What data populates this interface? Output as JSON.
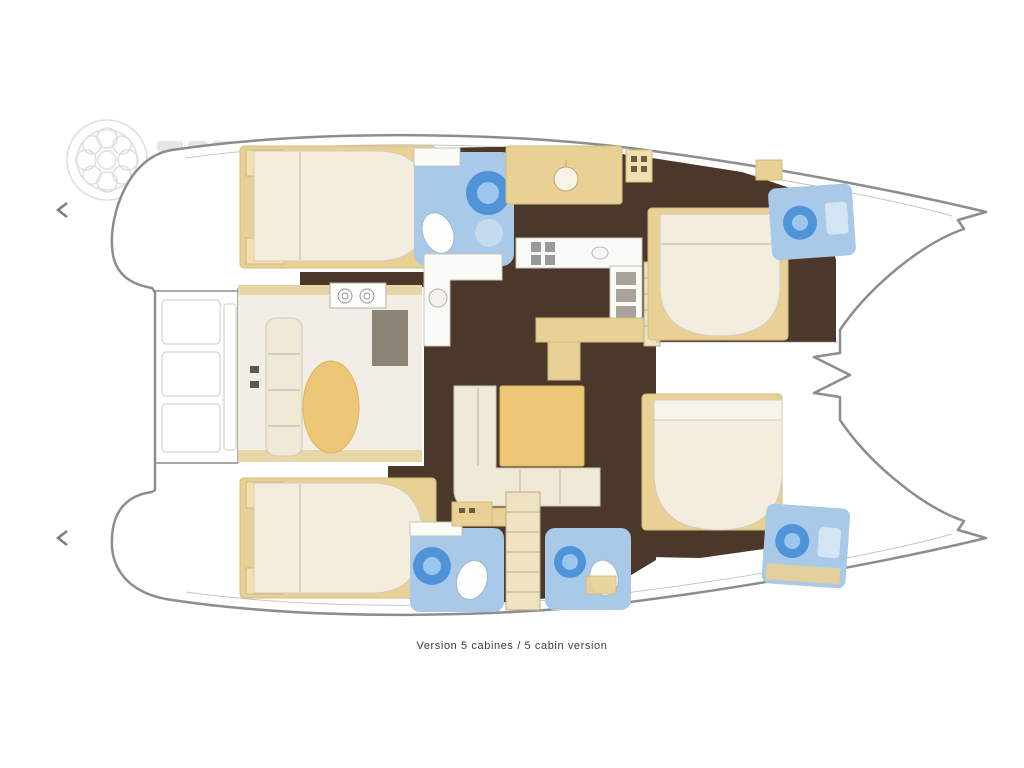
{
  "caption": {
    "text": "Version 5 cabines / 5 cabin version"
  },
  "palette": {
    "hull_outline": "#8d8d8d",
    "floor_dark": "#4c372b",
    "furniture_beige": "#e9d095",
    "band_beige": "#e6d6a8",
    "stairs_beige": "#efe3c2",
    "mattress_cream": "#f3edde",
    "sofa_cream": "#efe9d6",
    "bathroom_blue": "#a9c9e8",
    "fixture_blue_light": "#d3e5f5",
    "accent_tan": "#edc676",
    "counter_white": "#fafaf7",
    "floor_light": "#f2eee5",
    "desk_gray": "#8d8478",
    "appliance_gray": "#9a9a9a",
    "caption_color": "#3c3c3c"
  },
  "diagram": {
    "type": "catamaran-interior-floor-plan",
    "orientation": "bows-to-the-right",
    "areas": [
      {
        "id": "port-aft-cabin",
        "kind": "double-bed-cabin"
      },
      {
        "id": "port-aft-bathroom",
        "kind": "bathroom-with-shower"
      },
      {
        "id": "galley",
        "kind": "u-shaped-galley-with-stove"
      },
      {
        "id": "port-mid-lounge",
        "kind": "dressing-lounge-with-desk"
      },
      {
        "id": "port-forward-cabin",
        "kind": "double-bed-cabin"
      },
      {
        "id": "port-forward-bathroom",
        "kind": "bathroom"
      },
      {
        "id": "saloon",
        "kind": "l-sofa-with-table"
      },
      {
        "id": "nav-station",
        "kind": "chart-table-with-stool"
      },
      {
        "id": "companionway-stairs",
        "kind": "stairs"
      },
      {
        "id": "starboard-aft-cabin",
        "kind": "double-bed-cabin"
      },
      {
        "id": "starboard-aft-bathroom",
        "kind": "bathroom"
      },
      {
        "id": "mid-bathroom",
        "kind": "bathroom"
      },
      {
        "id": "starboard-forward-cabin",
        "kind": "double-bed-cabin"
      },
      {
        "id": "starboard-forward-bathroom",
        "kind": "bathroom"
      },
      {
        "id": "aft-cockpit",
        "kind": "cockpit-benches"
      },
      {
        "id": "foredeck",
        "kind": "foredeck-with-bowsprit"
      }
    ],
    "icons": [
      "ships-wheel-icon",
      "left-chevron-icon",
      "toilet-icon",
      "shower-icon",
      "stove-burners-icon",
      "sink-icon",
      "washer-icon"
    ]
  }
}
